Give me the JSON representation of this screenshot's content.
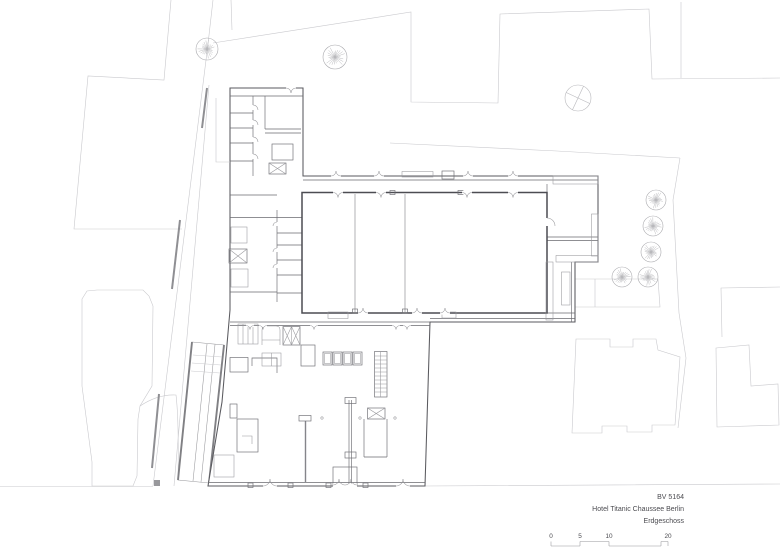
{
  "title_block": {
    "project_no": "BV 5164",
    "project_name": "Hotel Titanic Chaussee Berlin",
    "sheet_name": "Erdgeschoss"
  },
  "scale_bar": {
    "labels": [
      "0",
      "5",
      "10",
      "20"
    ],
    "x": [
      551,
      580,
      609,
      668
    ],
    "label_y": 538
  },
  "landscape": {
    "trees": [
      {
        "x": 207,
        "y": 49,
        "r": 11
      },
      {
        "x": 335,
        "y": 57,
        "r": 12
      },
      {
        "x": 656,
        "y": 200,
        "r": 10
      },
      {
        "x": 653,
        "y": 226,
        "r": 10
      },
      {
        "x": 651,
        "y": 252,
        "r": 10
      },
      {
        "x": 648,
        "y": 277,
        "r": 10
      },
      {
        "x": 622,
        "y": 277,
        "r": 10
      }
    ],
    "crossed_circle": {
      "x": 578,
      "y": 98,
      "r": 13
    }
  }
}
